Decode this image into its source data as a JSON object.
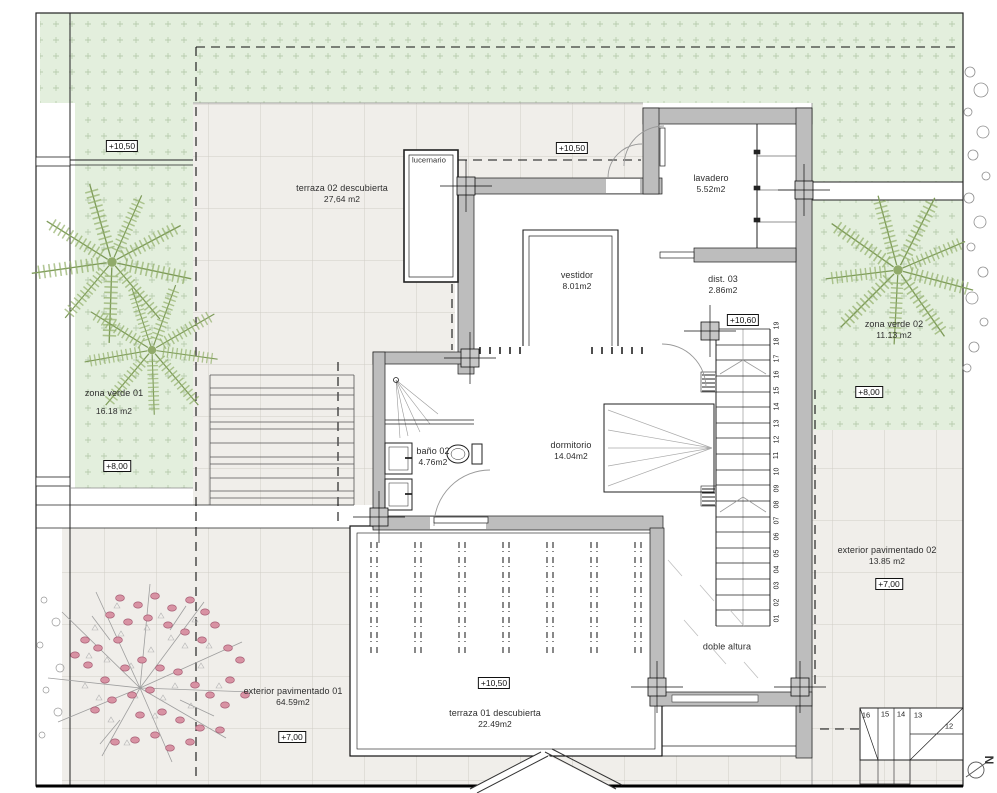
{
  "plan": {
    "rooms": {
      "terraza_02": {
        "name": "terraza 02 descubierta",
        "area": "27,64 m2"
      },
      "lucernario": {
        "name": "lucernario"
      },
      "vestidor": {
        "name": "vestidor",
        "area": "8.01m2"
      },
      "lavadero": {
        "name": "lavadero",
        "area": "5.52m2"
      },
      "dist_03": {
        "name": "dist. 03",
        "area": "2.86m2"
      },
      "dormitorio": {
        "name": "dormitorio",
        "area": "14.04m2"
      },
      "bano_02": {
        "name": "baño 02",
        "area": "4.76m2"
      },
      "doble_altura": {
        "name": "doble altura"
      },
      "terraza_01": {
        "name": "terraza 01 descubierta",
        "area": "22.49m2"
      },
      "zona_verde_01": {
        "name": "zona verde 01",
        "area": "16.18 m2"
      },
      "zona_verde_02": {
        "name": "zona verde 02",
        "area": "11.13 m2"
      },
      "exterior_pav_01": {
        "name": "exterior  pavimentado 01",
        "area": "64.59m2"
      },
      "exterior_pav_02": {
        "name": "exterior  pavimentado 02",
        "area": "13.85 m2"
      }
    },
    "levels": {
      "zona_verde_01_top": "+10,50",
      "terraza_02": "+10,50",
      "stairs_landing": "+10,60",
      "zona_verde_01": "+8,00",
      "zona_verde_02": "+8,00",
      "exterior_pav_01": "+7,00",
      "exterior_pav_02": "+7,00",
      "terraza_01": "+10,50"
    },
    "stairs": {
      "steps": [
        "01",
        "02",
        "03",
        "04",
        "05",
        "06",
        "07",
        "08",
        "09",
        "10",
        "11",
        "12",
        "13",
        "14",
        "15",
        "16",
        "17",
        "18",
        "19"
      ]
    },
    "exterior_stairs": {
      "steps": [
        "16",
        "15",
        "14",
        "13",
        "12"
      ]
    },
    "compass": {
      "label": "N"
    },
    "colors": {
      "zona_verde": "#e3efdd",
      "pavement": "#f0eeea",
      "wall": "#bdbdbd",
      "palm": "#93b06b",
      "blossom": "#d892a3"
    }
  }
}
